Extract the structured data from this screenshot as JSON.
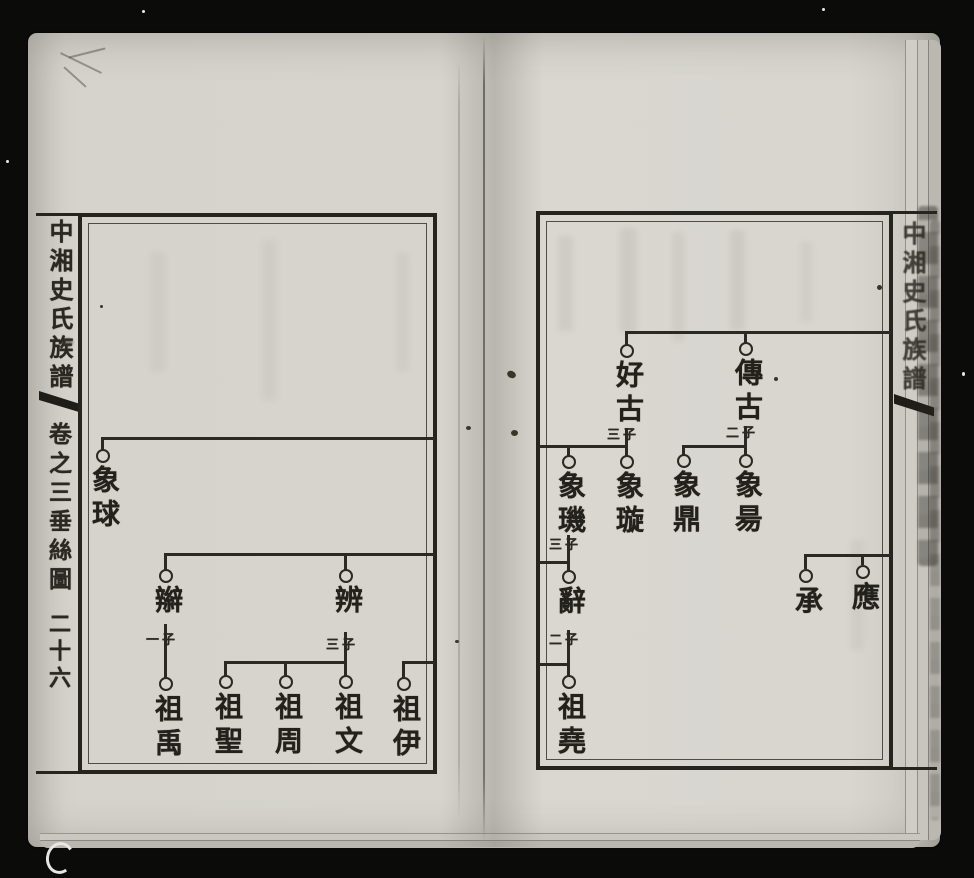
{
  "book": {
    "left_page": {
      "margin": {
        "book_title": "中湘史氏族譜",
        "volume_label": "卷之三",
        "chart_label": "垂絲圖",
        "page_number": "二十六"
      },
      "nodes": {
        "xiang_qiu": {
          "name": "象球"
        },
        "bian_braid": {
          "name": "辮",
          "sons": "一子"
        },
        "bian": {
          "name": "辨",
          "sons": "三子"
        },
        "zu_yu": {
          "name": "祖禹"
        },
        "zu_sheng": {
          "name": "祖聖"
        },
        "zu_zhou": {
          "name": "祖周"
        },
        "zu_wen": {
          "name": "祖文"
        },
        "zu_yi": {
          "name": "祖伊"
        }
      }
    },
    "right_page": {
      "margin": {
        "book_title": "中湘史氏族譜"
      },
      "nodes": {
        "hao_gu": {
          "name": "好古",
          "sons": "三子"
        },
        "chuan_gu": {
          "name": "傳古",
          "sons": "二子"
        },
        "xiang_ji": {
          "name": "象璣",
          "sons": "三子"
        },
        "xiang_xuan": {
          "name": "象璇"
        },
        "xiang_ding": {
          "name": "象鼎"
        },
        "xiang_yang": {
          "name": "象昜"
        },
        "ci": {
          "name": "辭",
          "sons": "二子"
        },
        "zu_yao": {
          "name": "祖堯"
        },
        "cheng": {
          "name": "承"
        },
        "ying": {
          "name": "應"
        }
      }
    }
  }
}
